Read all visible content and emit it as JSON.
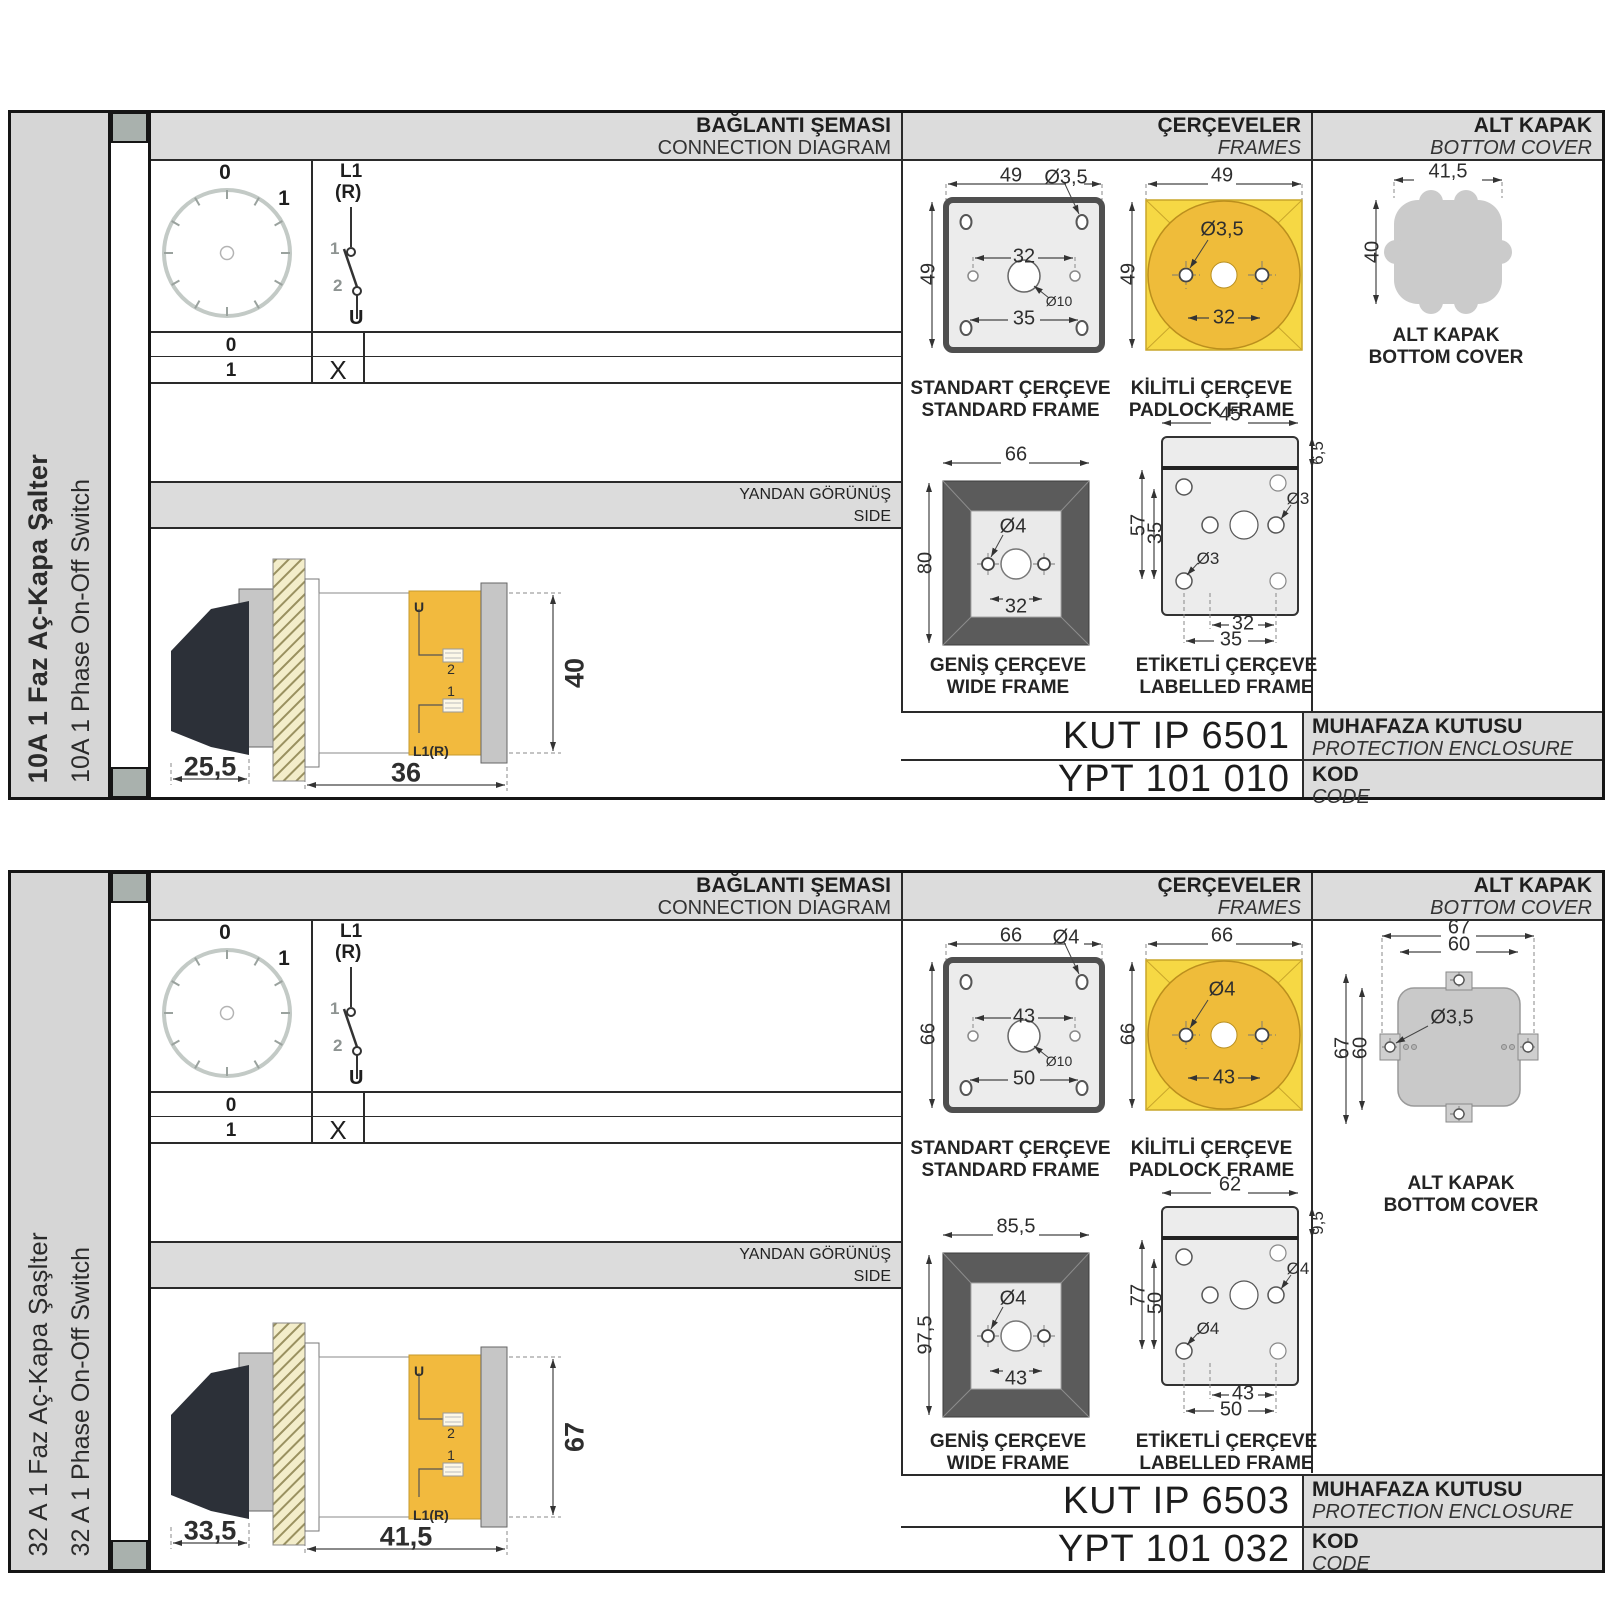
{
  "sections": [
    {
      "side_label_tr": "10A 1 Faz Aç-Kapa Şalter",
      "side_label_en": "10A 1 Phase On-Off Switch",
      "connection": {
        "title_tr": "BAĞLANTI ŞEMASI",
        "title_en": "CONNECTION DIAGRAM",
        "dial": {
          "pos0": "0",
          "pos1": "1"
        },
        "switch": {
          "l1": "L1",
          "r": "(R)",
          "c1": "1",
          "c2": "2",
          "u": "U"
        },
        "table": {
          "row0": "0",
          "row1": "1",
          "x_mark": "X"
        }
      },
      "side_view": {
        "title_tr": "YANDAN GÖRÜNÜŞ",
        "title_en": "SIDE",
        "dim_handle": "25,5",
        "dim_body": "36",
        "dim_height": "40",
        "term_u": "U",
        "term_2": "2",
        "term_1": "1",
        "term_l1r": "L1(R)"
      },
      "frames": {
        "title_tr": "ÇERÇEVELER",
        "title_en": "FRAMES",
        "standard": {
          "label_tr": "STANDART ÇERÇEVE",
          "label_en": "STANDARD FRAME",
          "dim_top": "49",
          "dim_hole": "Ø3,5",
          "dim_left": "49",
          "dim_inner": "32",
          "dim_center": "Ø10",
          "dim_bottom": "35"
        },
        "padlock": {
          "label_tr": "KİLİTLİ ÇERÇEVE",
          "label_en": "PADLOCK FRAME",
          "dim_top": "49",
          "dim_left": "49",
          "dim_hole": "Ø3,5",
          "dim_inner": "32"
        },
        "wide": {
          "label_tr": "GENİŞ ÇERÇEVE",
          "label_en": "WIDE FRAME",
          "dim_top": "66",
          "dim_left": "80",
          "dim_hole": "Ø4",
          "dim_inner": "32"
        },
        "labelled": {
          "label_tr": "ETİKETLİ ÇERÇEVE",
          "label_en": "LABELLED FRAME",
          "dim_top": "45",
          "dim_band": "6,5",
          "dim_left_outer": "57",
          "dim_left_inner": "35",
          "dim_hole_right": "Ø3",
          "dim_hole_left": "Ø3",
          "dim_bottom_a": "32",
          "dim_bottom_b": "35"
        }
      },
      "bottom_cover": {
        "title_tr": "ALT KAPAK",
        "title_en": "BOTTOM COVER",
        "dim_top": "41,5",
        "dim_left": "40",
        "label_tr": "ALT KAPAK",
        "label_en": "BOTTOM COVER"
      },
      "codes": {
        "enclosure_code": "KUT IP 6501",
        "enclosure_label_tr": "MUHAFAZA KUTUSU",
        "enclosure_label_en": "PROTECTION ENCLOSURE",
        "code_value": "YPT 101 010",
        "code_label_tr": "KOD",
        "code_label_en": "CODE"
      }
    },
    {
      "side_label_tr": "32 A 1 Faz Aç-Kapa Şaşlter",
      "side_label_en": "32 A 1 Phase On-Off Switch",
      "connection": {
        "title_tr": "BAĞLANTI ŞEMASI",
        "title_en": "CONNECTION DIAGRAM",
        "dial": {
          "pos0": "0",
          "pos1": "1"
        },
        "switch": {
          "l1": "L1",
          "r": "(R)",
          "c1": "1",
          "c2": "2",
          "u": "U"
        },
        "table": {
          "row0": "0",
          "row1": "1",
          "x_mark": "X"
        }
      },
      "side_view": {
        "title_tr": "YANDAN GÖRÜNÜŞ",
        "title_en": "SIDE",
        "dim_handle": "33,5",
        "dim_body": "41,5",
        "dim_height": "67",
        "term_u": "U",
        "term_2": "2",
        "term_1": "1",
        "term_l1r": "L1(R)"
      },
      "frames": {
        "title_tr": "ÇERÇEVELER",
        "title_en": "FRAMES",
        "standard": {
          "label_tr": "STANDART ÇERÇEVE",
          "label_en": "STANDARD FRAME",
          "dim_top": "66",
          "dim_hole": "Ø4",
          "dim_left": "66",
          "dim_inner": "43",
          "dim_center": "Ø10",
          "dim_bottom": "50"
        },
        "padlock": {
          "label_tr": "KİLİTLİ ÇERÇEVE",
          "label_en": "PADLOCK FRAME",
          "dim_top": "66",
          "dim_left": "66",
          "dim_hole": "Ø4",
          "dim_inner": "43"
        },
        "wide": {
          "label_tr": "GENİŞ ÇERÇEVE",
          "label_en": "WIDE FRAME",
          "dim_top": "85,5",
          "dim_left": "97,5",
          "dim_hole": "Ø4",
          "dim_inner": "43"
        },
        "labelled": {
          "label_tr": "ETİKETLİ ÇERÇEVE",
          "label_en": "LABELLED FRAME",
          "dim_top": "62",
          "dim_band": "9,5",
          "dim_left_outer": "77",
          "dim_left_inner": "50",
          "dim_hole_right": "Ø4",
          "dim_hole_left": "Ø4",
          "dim_bottom_a": "43",
          "dim_bottom_b": "50"
        }
      },
      "bottom_cover": {
        "title_tr": "ALT KAPAK",
        "title_en": "BOTTOM COVER",
        "dim_top_outer": "67",
        "dim_top_inner": "60",
        "dim_left_outer": "67",
        "dim_left_inner": "60",
        "dim_hole": "Ø3,5",
        "label_tr": "ALT KAPAK",
        "label_en": "BOTTOM COVER"
      },
      "codes": {
        "enclosure_code": "KUT IP 6503",
        "enclosure_label_tr": "MUHAFAZA KUTUSU",
        "enclosure_label_en": "PROTECTION ENCLOSURE",
        "code_value": "YPT 101 032",
        "code_label_tr": "KOD",
        "code_label_en": "CODE"
      }
    }
  ]
}
